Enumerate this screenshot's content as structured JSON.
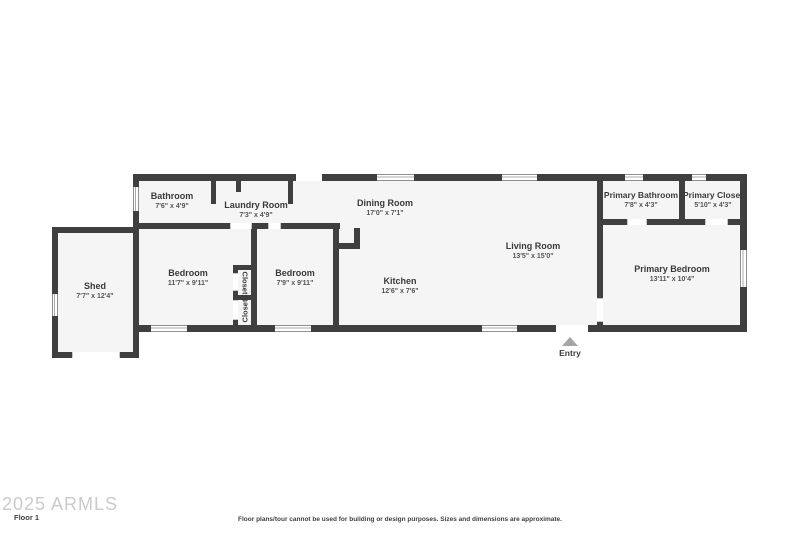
{
  "plan": {
    "floor_label": "Floor 1",
    "watermark": "2025 ARMLS",
    "disclaimer": "Floor plans/tour cannot be used for building or design purposes. Sizes and dimensions are approximate.",
    "entry_label": "Entry"
  },
  "rooms": [
    {
      "name": "Bathroom",
      "dims": "7'6\" x 4'9\""
    },
    {
      "name": "Laundry Room",
      "dims": "7'3\" x 4'9\""
    },
    {
      "name": "Dining Room",
      "dims": "17'0\" x 7'1\""
    },
    {
      "name": "Living Room",
      "dims": "13'5\" x 15'0\""
    },
    {
      "name": "Kitchen",
      "dims": "12'6\" x 7'6\""
    },
    {
      "name": "Bedroom",
      "dims": "11'7\" x 9'11\""
    },
    {
      "name": "Bedroom",
      "dims": "7'9\" x 9'11\""
    },
    {
      "name": "Shed",
      "dims": "7'7\" x 12'4\""
    },
    {
      "name": "Primary Bathroom",
      "dims": "7'8\" x 4'3\""
    },
    {
      "name": "Primary Closet",
      "dims": "5'10\" x 4'3\""
    },
    {
      "name": "Primary Bedroom",
      "dims": "13'11\" x 10'4\""
    }
  ],
  "closets": {
    "top": "Closet",
    "bottom": "Closet"
  },
  "colors": {
    "wall": "#3f3f3f",
    "room_fill": "#f5f5f5",
    "background": "#ffffff",
    "label_text": "#3a3a3a",
    "dimension_text": "#555555",
    "entry_arrow": "#a5a5a5",
    "watermark": "#cbcbcb"
  }
}
